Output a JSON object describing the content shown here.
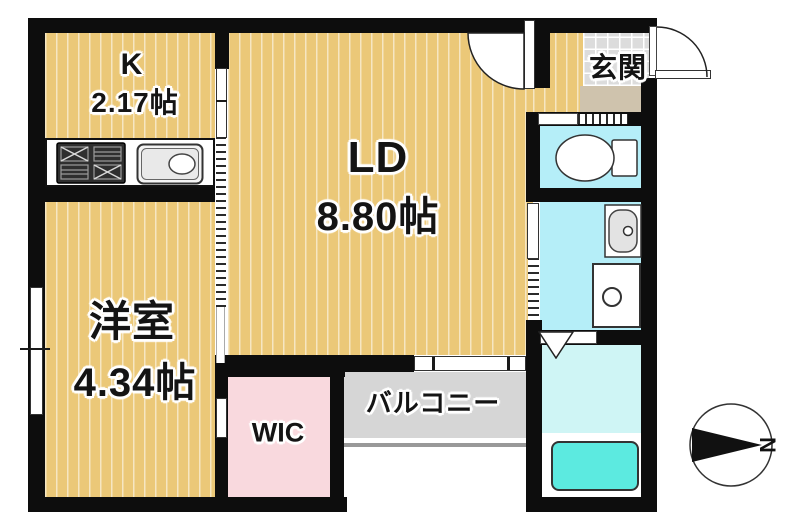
{
  "rooms": {
    "kitchen": {
      "label": "K",
      "area": "2.17帖"
    },
    "living_dining": {
      "label": "LD",
      "area": "8.80帖"
    },
    "western_room": {
      "label": "洋室",
      "area": "4.34帖"
    },
    "entrance": {
      "label": "玄関"
    },
    "wic": {
      "label": "WIC"
    },
    "balcony": {
      "label": "バルコニー"
    }
  },
  "compass": {
    "north_label": "N"
  },
  "fixtures": {
    "stove": "gas-stove-icon",
    "sink": "kitchen-sink-icon",
    "toilet": "toilet-icon",
    "washbasin": "washbasin-icon",
    "washing_machine": "washing-machine-icon",
    "bathtub": "bathtub-icon"
  },
  "colors": {
    "wall_black": "#0d0d0d",
    "floor_tan": "#ebc878",
    "wet_cyan": "#b5eef8",
    "bath_floor": "#cff5f5",
    "bathtub_cyan": "#5ceae0",
    "wic_pink": "#f9d9de",
    "tile_gray": "#dcdcdc",
    "step_beige": "#cfc3ad",
    "balcony_gray": "#d6d6d6"
  }
}
